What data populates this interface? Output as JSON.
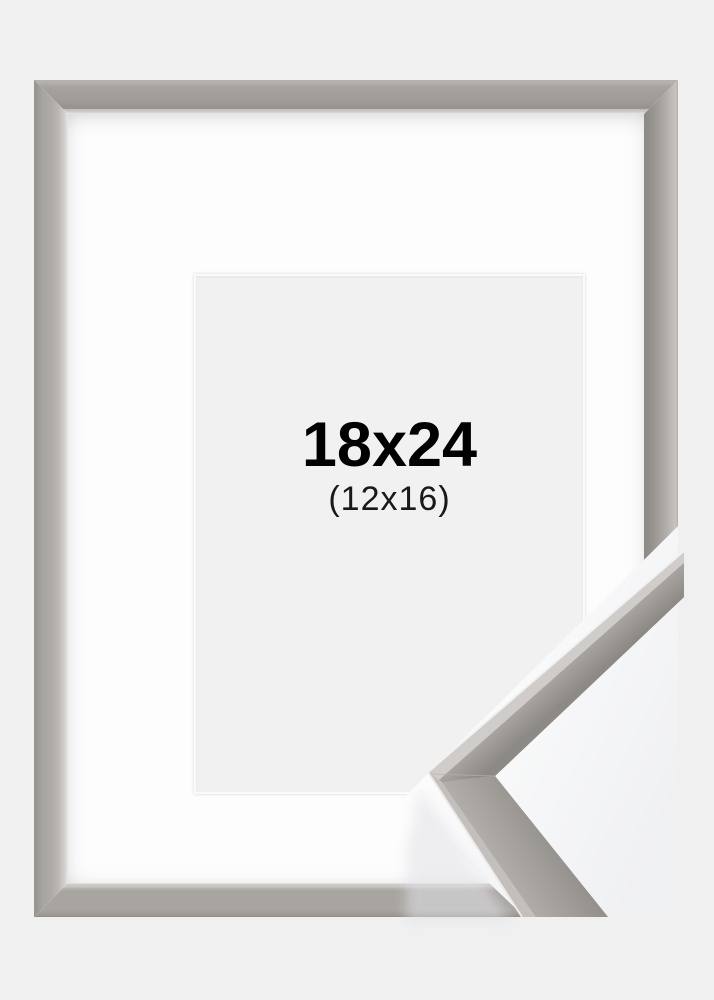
{
  "product": {
    "size_label": "18x24",
    "matted_size_label": "(12x16)",
    "colors": {
      "background": "#f0f0f1",
      "mat": "#fdfdfd",
      "aperture_fill": "#f1f1f2",
      "frame_grey": "#a6a29e",
      "frame_grey_dark": "#8e8a86",
      "frame_grey_light": "#cfccc9",
      "cutout_white": "#ffffff",
      "label_text": "#121212"
    }
  }
}
